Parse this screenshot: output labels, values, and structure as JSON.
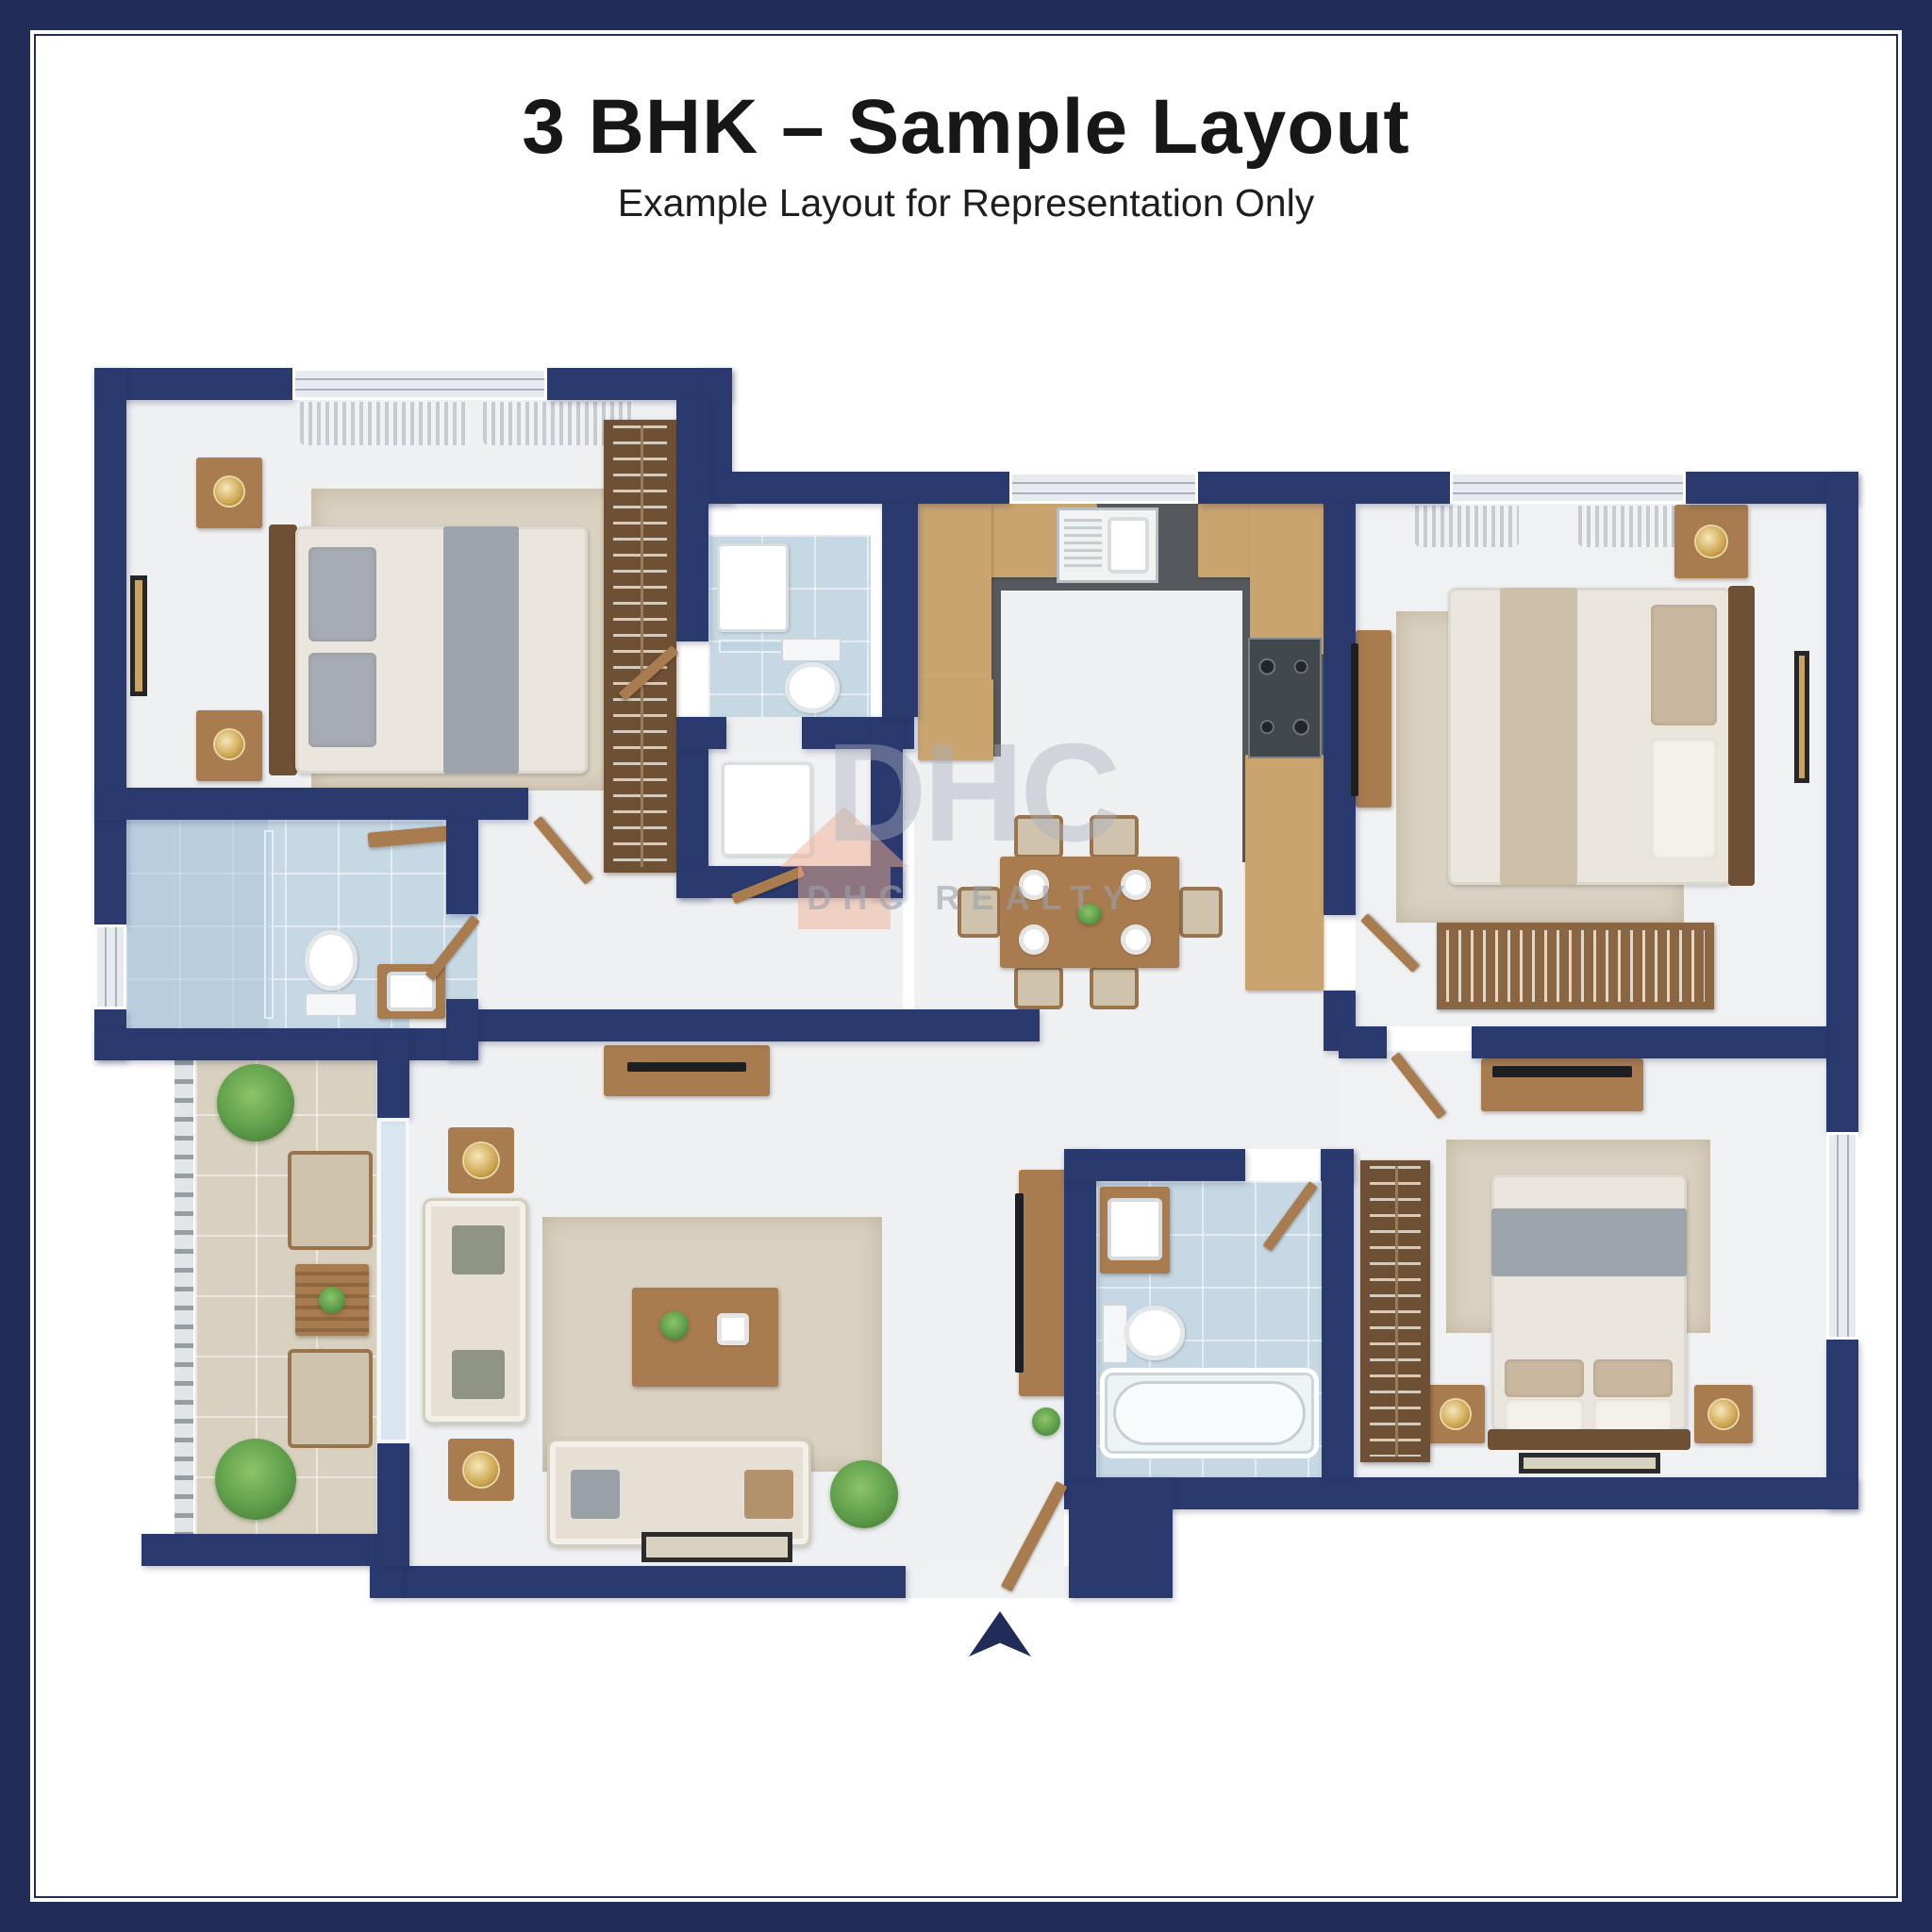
{
  "header": {
    "title": "3 BHK – Sample Layout",
    "subtitle": "Example Layout for Representation Only"
  },
  "watermark": {
    "logo_text": "DHC",
    "brand_text": "DHC REALTY"
  },
  "floor_plan": {
    "type": "top-down 3D rendered apartment floor plan",
    "entrance": "bottom-center doorway marked with a navy direction arrow",
    "rooms": [
      {
        "name": "master-bedroom",
        "position": "top-left",
        "furniture": [
          "double bed with gray throw",
          "two nightstands with gold lamps",
          "wall art",
          "rug",
          "curtained windows",
          "tall wardrobe with hangers"
        ]
      },
      {
        "name": "bathroom-top",
        "position": "top-center-left",
        "fixtures": [
          "shower tray",
          "glass shelf",
          "toilet"
        ]
      },
      {
        "name": "utility-closet",
        "position": "center-left",
        "fixtures": [
          "white appliance"
        ]
      },
      {
        "name": "kitchen",
        "position": "top-center",
        "fixtures": [
          "U-shaped dark countertop",
          "sink under window",
          "4-burner hob",
          "wood cabinets"
        ]
      },
      {
        "name": "bedroom-2",
        "position": "top-right",
        "furniture": [
          "double bed with beige runner",
          "nightstand with lamp",
          "TV unit",
          "slatted bookshelf",
          "rug",
          "curtained window",
          "wall art"
        ]
      },
      {
        "name": "bathroom-left",
        "position": "middle-left",
        "fixtures": [
          "glass shower",
          "toilet",
          "vanity sink",
          "wood shelf",
          "window"
        ]
      },
      {
        "name": "balcony",
        "position": "bottom-left",
        "furniture": [
          "railing",
          "two rattan armchairs",
          "slatted side table",
          "two green plants"
        ]
      },
      {
        "name": "living-room",
        "position": "bottom-center-left",
        "furniture": [
          "L-arranged sofas",
          "coffee table",
          "two side tables",
          "rug",
          "console with TV",
          "potted plant",
          "doormat"
        ]
      },
      {
        "name": "dining-area",
        "position": "center",
        "furniture": [
          "6-seat wood dining table",
          "4 place settings"
        ]
      },
      {
        "name": "bathroom-bottom",
        "position": "bottom-center",
        "fixtures": [
          "vanity sink",
          "toilet",
          "bathtub"
        ]
      },
      {
        "name": "bedroom-3",
        "position": "bottom-right",
        "furniture": [
          "double bed with gray throw",
          "two nightstands with lamps",
          "open wardrobe with hangers",
          "TV console",
          "rug",
          "floor mat",
          "window"
        ]
      }
    ]
  },
  "colors": {
    "frame": "#222c59",
    "wall": "#2a3a6e",
    "floor": "#eef0f2",
    "tile": "#c6d8e4",
    "btile": "#d8d1c0",
    "wood": "#a97c4f",
    "counter": "#55595d",
    "rug": "#d9d1c1",
    "plant": "#5f9e4a",
    "wmgray": "#aab0bd",
    "wmorange": "#f2b193"
  }
}
